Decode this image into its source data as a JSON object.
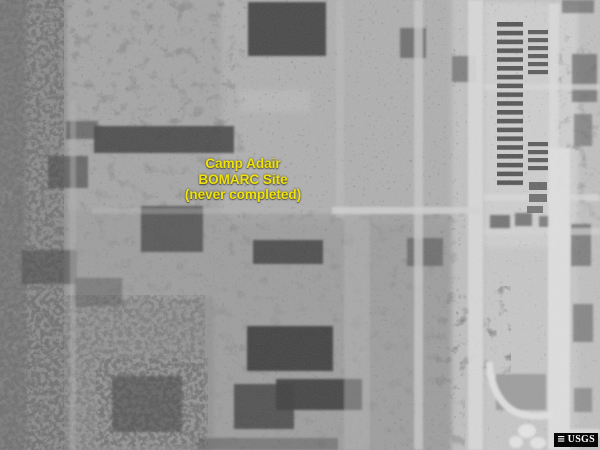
{
  "caption": {
    "line1": "Camp Adair",
    "line2": "BOMARC Site",
    "line3": "(never completed)",
    "color": "#f0e20a"
  },
  "watermark": {
    "label": "USGS",
    "icon_glyph": "≡",
    "icon_name": "usgs-layers-icon",
    "bg": "#060606",
    "fg": "#ffffff"
  },
  "palette": {
    "terrain_base": "#a6a6a6",
    "terrain_light_right": "#c2c2c2",
    "cantonment_bright": "#d0d0d0",
    "road_bright": "#e0e0e0",
    "grove_dark": "#3a3a3a",
    "forest_edge": "#8b8b8b"
  }
}
